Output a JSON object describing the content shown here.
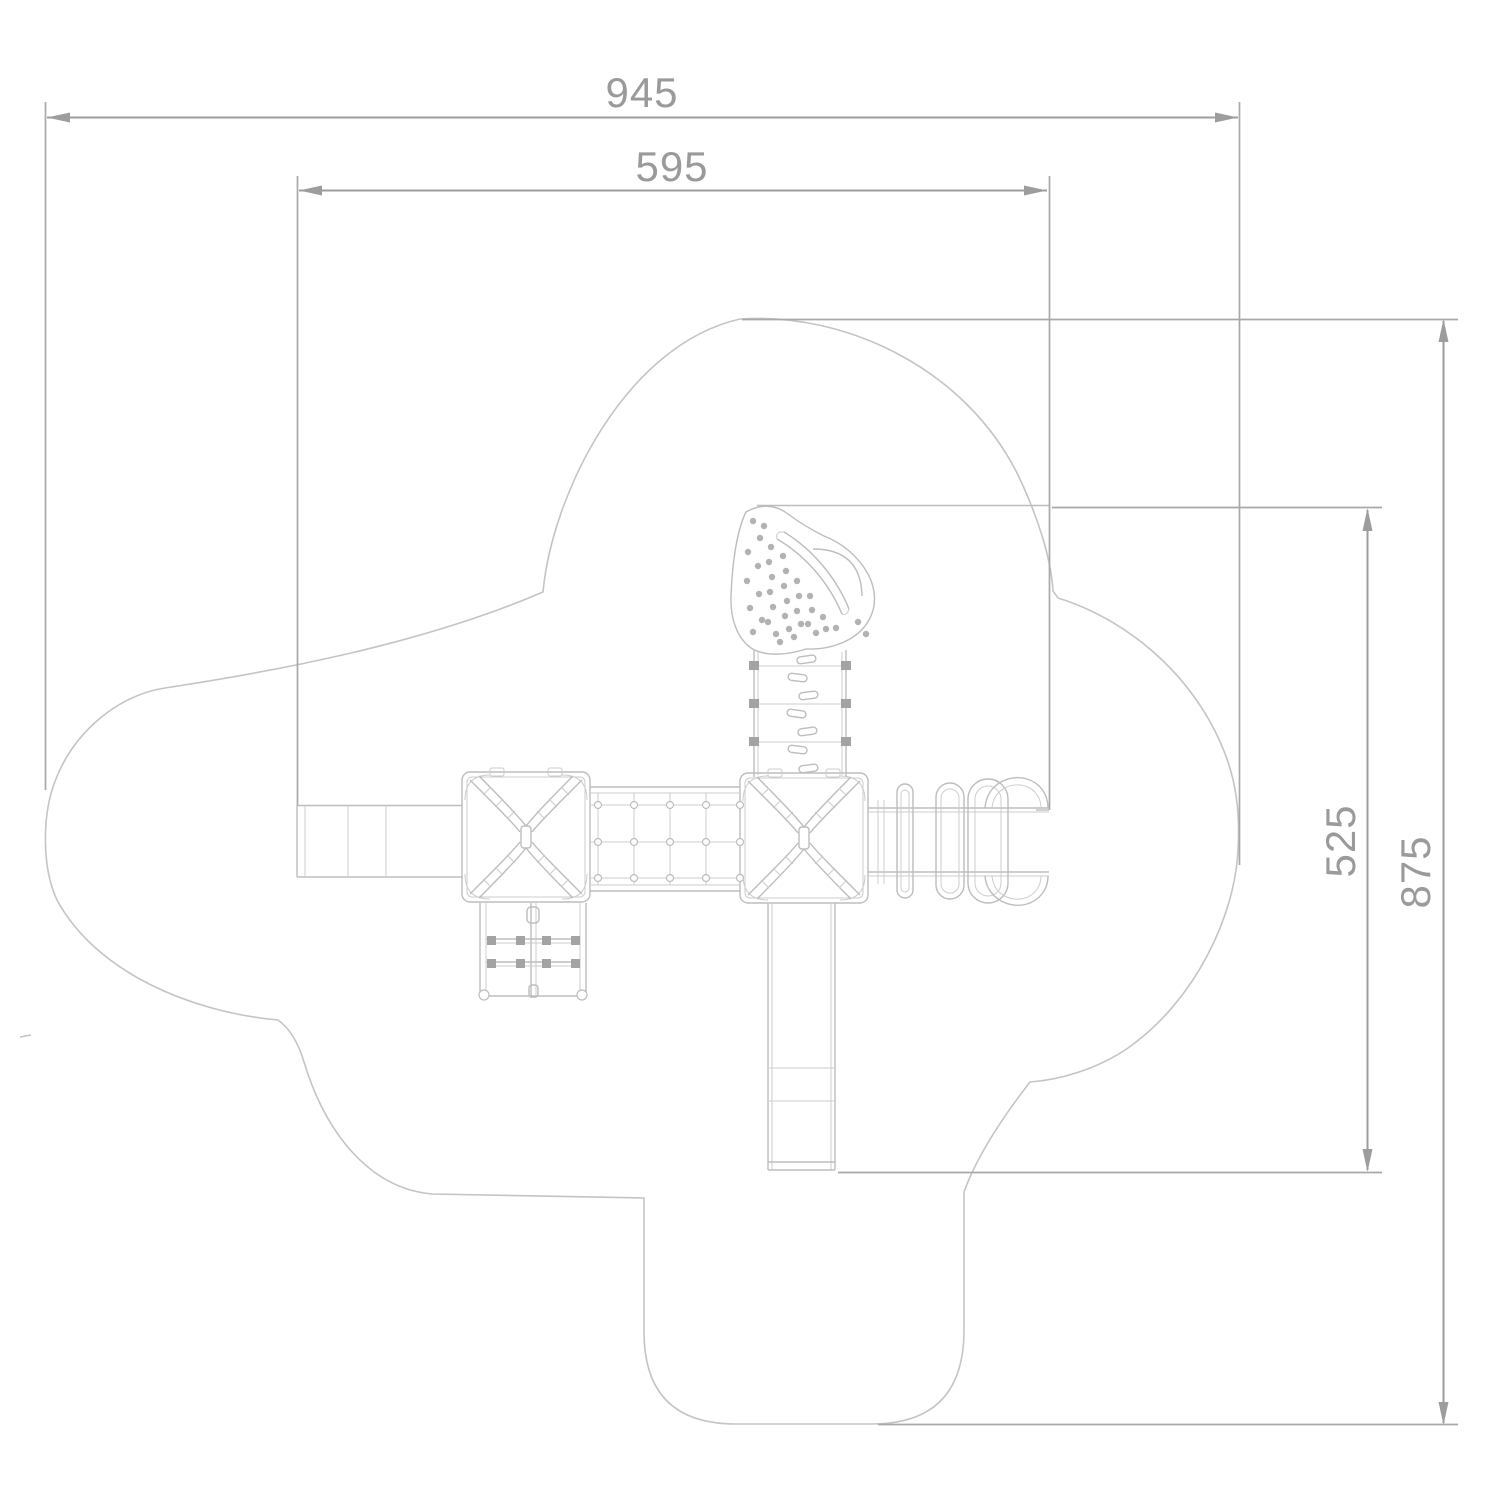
{
  "drawing": {
    "labels": {
      "total_width": "945",
      "platform_width": "595",
      "inner_height": "525",
      "total_height": "875"
    },
    "colors": {
      "background": "#ffffff",
      "safety_zone_outline": "#c4c4c4",
      "equipment_line": "#bdbdbd",
      "dimension_line": "#9d9d9d",
      "dimension_text": "#9a9a9a"
    }
  }
}
